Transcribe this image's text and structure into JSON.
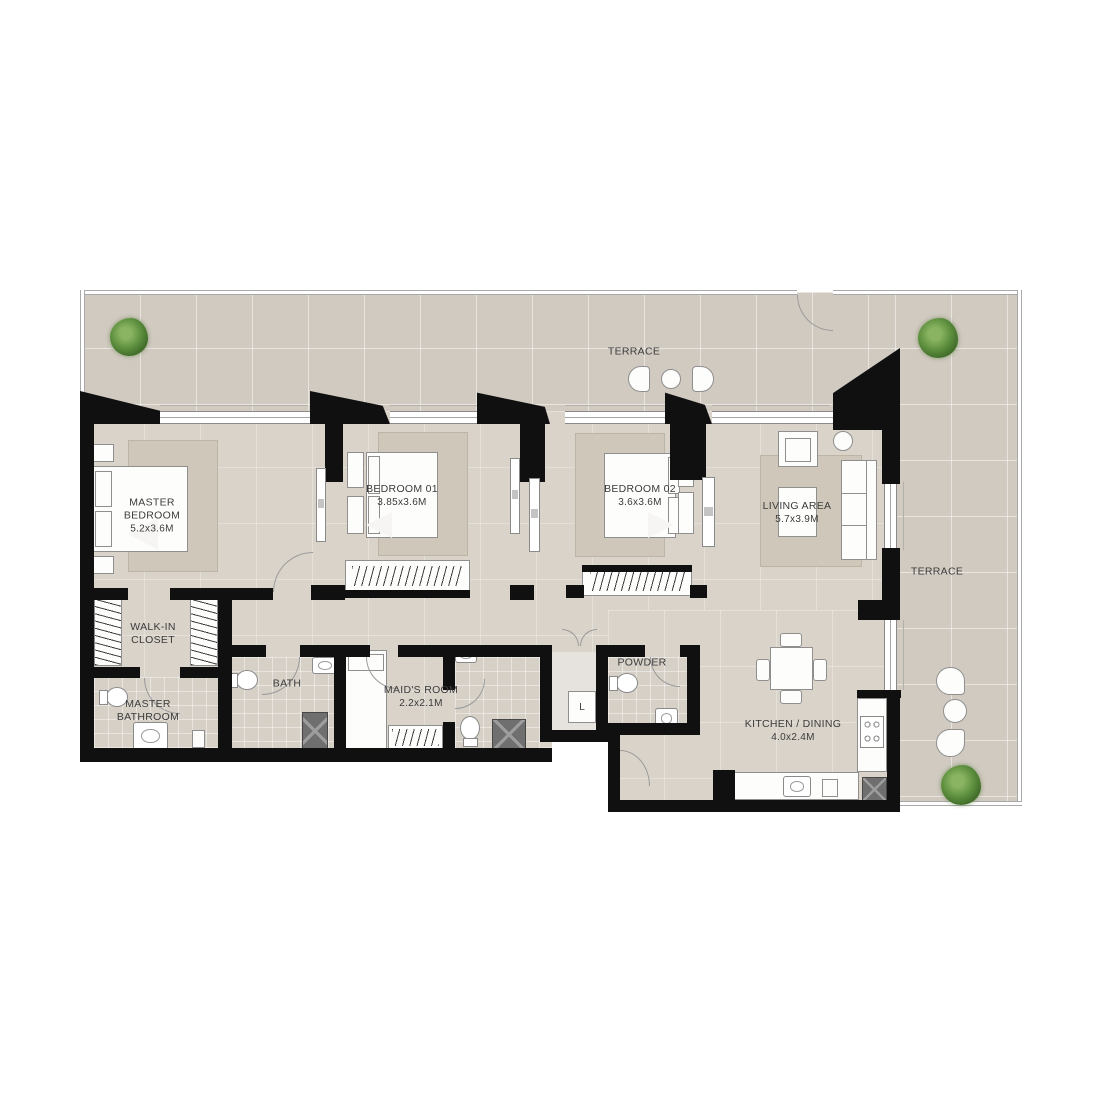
{
  "rooms": {
    "terrace_top": {
      "name": "TERRACE"
    },
    "terrace_right": {
      "name": "TERRACE"
    },
    "master_bedroom": {
      "name": "MASTER BEDROOM",
      "dims": "5.2x3.6M"
    },
    "bedroom_01": {
      "name": "BEDROOM 01",
      "dims": "3.85x3.6M"
    },
    "bedroom_02": {
      "name": "BEDROOM 02",
      "dims": "3.6x3.6M"
    },
    "living_area": {
      "name": "LIVING AREA",
      "dims": "5.7x3.9M"
    },
    "walk_in_closet": {
      "name": "WALK-IN CLOSET"
    },
    "master_bathroom": {
      "name": "MASTER BATHROOM"
    },
    "bath": {
      "name": "BATH"
    },
    "maids_room": {
      "name": "MAID'S ROOM",
      "dims": "2.2x2.1M"
    },
    "powder": {
      "name": "POWDER"
    },
    "laundry": {
      "name": "L"
    },
    "kitchen_dining": {
      "name": "KITCHEN / DINING",
      "dims": "4.0x2.4M"
    }
  },
  "colors": {
    "wall": "#101010",
    "terrace_floor": "#d1cac1",
    "interior_floor": "#d9d3ca",
    "rug": "#cfc8ba",
    "plant_green": "#5d8f3e",
    "fixture_dark": "#6f6f6f",
    "furniture_outline": "#8f8f8f",
    "label_text": "#3b3b3b"
  }
}
